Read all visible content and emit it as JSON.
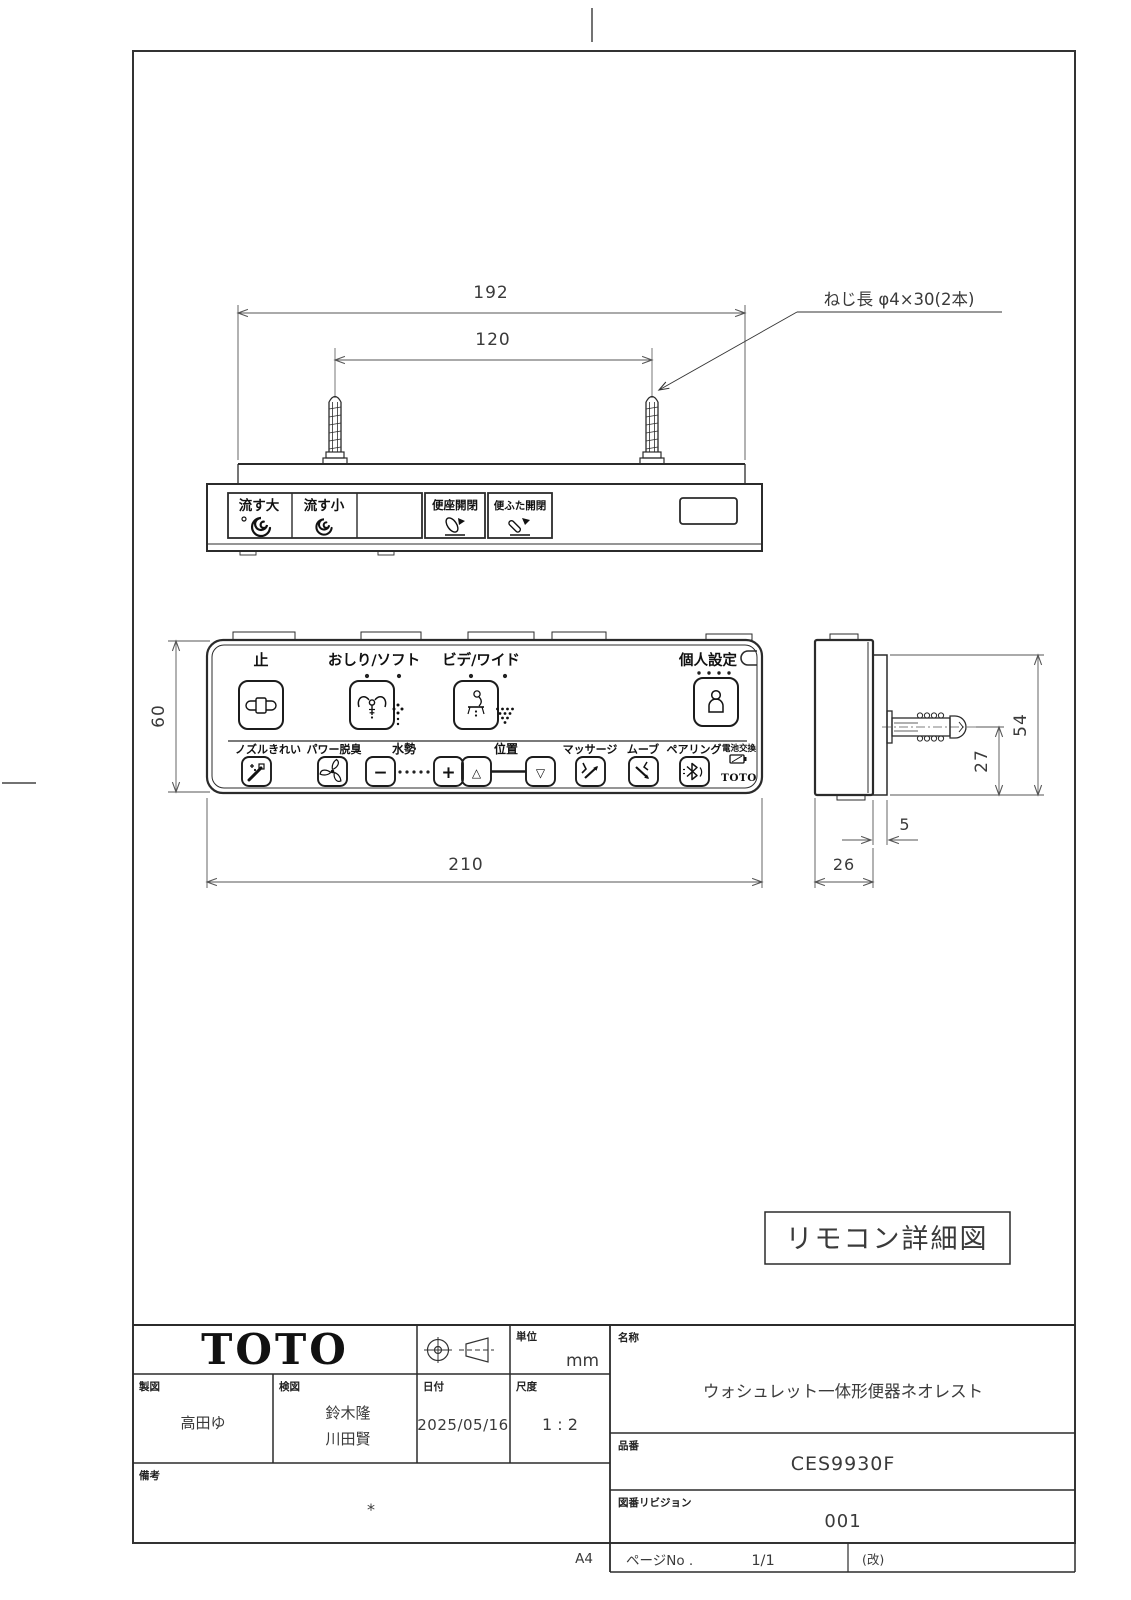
{
  "document": {
    "caption": "リモコン詳細図",
    "paper_size": "A4"
  },
  "top_view": {
    "dims": {
      "overall_width": "192",
      "screw_pitch": "120"
    },
    "screw_note": "ねじ長 φ4×30(2本)",
    "buttons": [
      {
        "label": "流す大",
        "icon": "flush-large-swirl"
      },
      {
        "label": "流す小",
        "icon": "flush-small-swirl"
      },
      {
        "label": ""
      },
      {
        "label": "便座開閉",
        "icon": "seat-open-close"
      },
      {
        "label": "便ふた開閉",
        "icon": "lid-open-close"
      }
    ]
  },
  "front_view": {
    "dims": {
      "height": "60",
      "width": "210"
    },
    "top_row": {
      "stop": "止",
      "oshiri_soft": "おしり/ソフト",
      "bidet_wide": "ビデ/ワイド",
      "personal": "個人設定"
    },
    "bottom_row": {
      "nozzle_clean": "ノズルきれい",
      "power_deodorize": "パワー脱臭",
      "water_pressure": "水勢",
      "minus": "−",
      "plus": "+",
      "position": "位置",
      "up": "△",
      "down": "▽",
      "massage": "マッサージ",
      "move": "ムーブ",
      "pairing": "ペアリング",
      "battery_replace": "電池交換",
      "brand": "TOTO"
    }
  },
  "side_view": {
    "dims": {
      "height": "54",
      "screw_center": "27",
      "plate_depth": "5",
      "body_depth": "26"
    }
  },
  "title_block": {
    "brand": "TOTO",
    "unit": {
      "label": "単位",
      "value": "mm"
    },
    "drafter": {
      "label": "製図",
      "value": "高田ゆ"
    },
    "checker": {
      "label": "検図",
      "values": [
        "鈴木隆",
        "川田賢"
      ]
    },
    "date": {
      "label": "日付",
      "value": "2025/05/16"
    },
    "scale": {
      "label": "尺度",
      "value": "1 : 2"
    },
    "name": {
      "label": "名称",
      "value": "ウォシュレット一体形便器ネオレスト"
    },
    "part_no": {
      "label": "品番",
      "value": "CES9930F"
    },
    "revision": {
      "label": "図番リビジョン",
      "value": "001"
    },
    "page": {
      "label": "ページNo .",
      "value": "1/1",
      "rev_mark": "(改)"
    },
    "remarks": {
      "label": "備考",
      "value": "*"
    }
  }
}
